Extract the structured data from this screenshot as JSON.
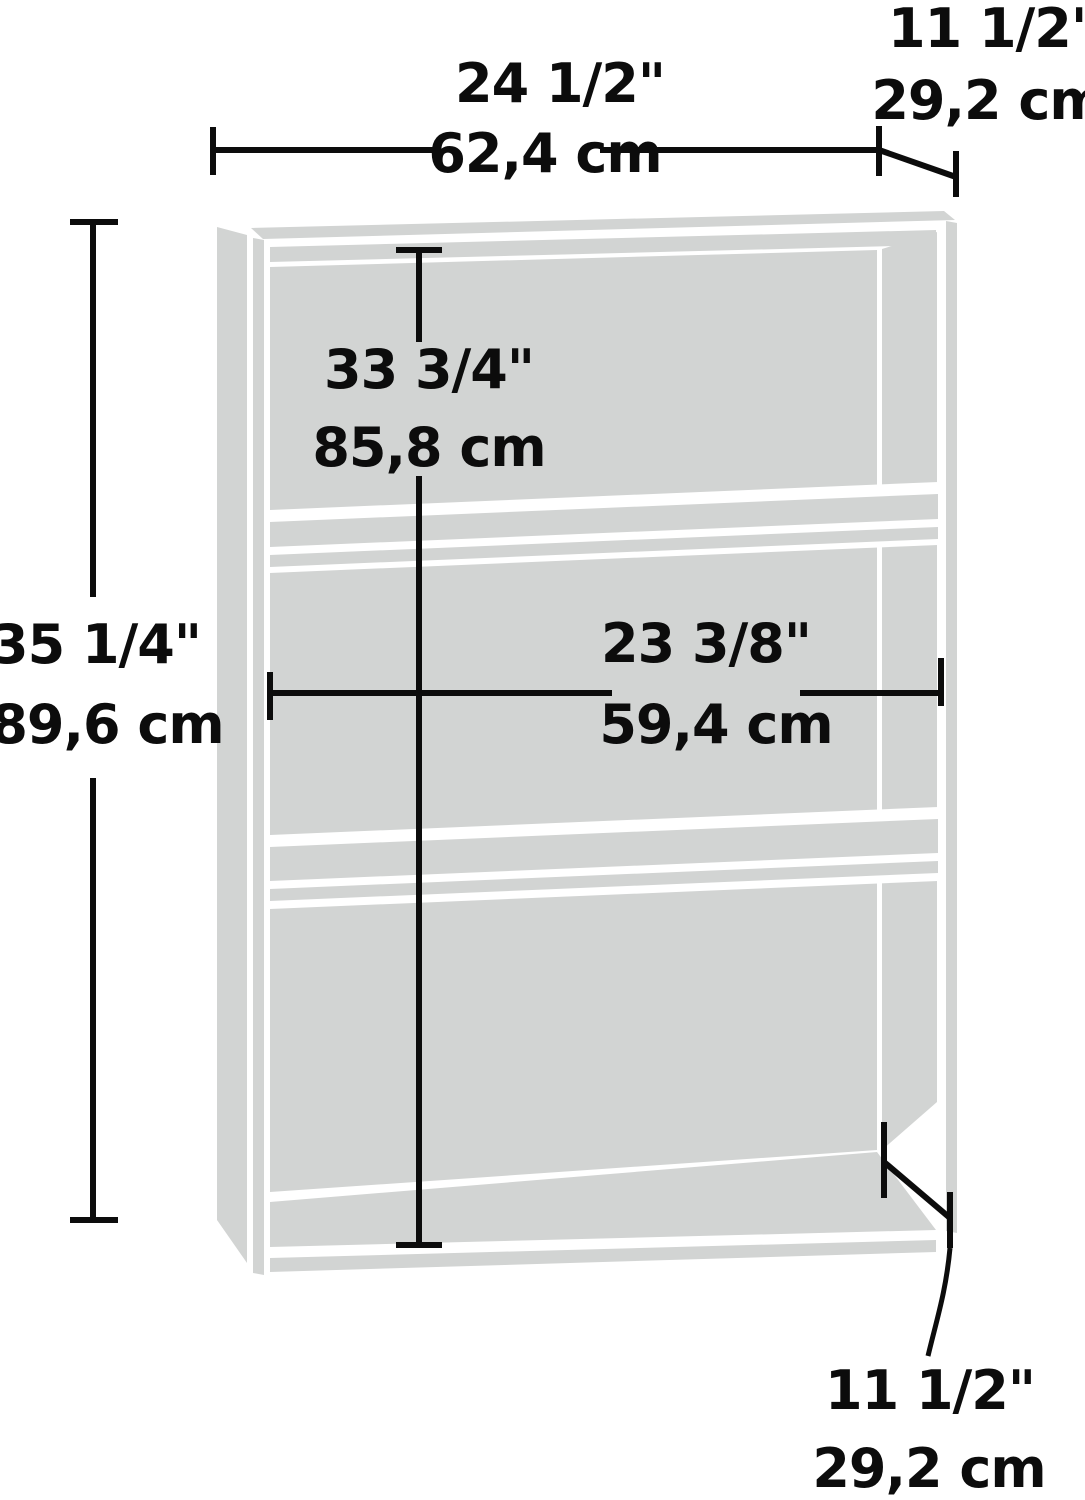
{
  "diagram": {
    "type": "furniture-dimension-diagram",
    "subject": "3-shelf bookcase line drawing with dimension callouts",
    "colors": {
      "panel_gray": "#d2d4d3",
      "dimension_line": "#0c0c0c",
      "background": "#ffffff"
    },
    "annotations": {
      "overall_width": {
        "inches": "24 1/2\"",
        "metric": "62,4 cm"
      },
      "top_depth": {
        "inches": "11 1/2\"",
        "metric": "29,2 cm"
      },
      "overall_height": {
        "inches": "35 1/4\"",
        "metric": "89,6 cm"
      },
      "interior_height": {
        "inches": "33 3/4\"",
        "metric": "85,8 cm"
      },
      "interior_width": {
        "inches": "23 3/8\"",
        "metric": "59,4 cm"
      },
      "bottom_depth": {
        "inches": "11 1/2\"",
        "metric": "29,2 cm"
      }
    }
  }
}
